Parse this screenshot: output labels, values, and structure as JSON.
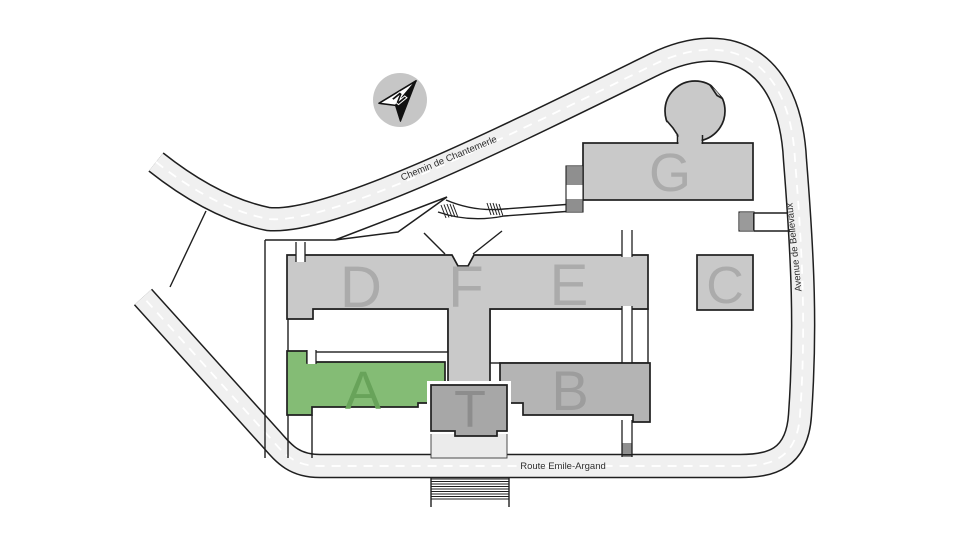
{
  "map": {
    "compass": {
      "label": "N"
    },
    "roads": {
      "chantemerle": {
        "label": "Chemin de Chantemerle"
      },
      "bellevaux": {
        "label": "Avenue de Bellevaux"
      },
      "emile_argand": {
        "label": "Route Emile-Argand"
      }
    },
    "buildings": {
      "a": {
        "label": "A",
        "fill": "#84bc75",
        "letter_color": "#68a35a",
        "highlighted": true
      },
      "b": {
        "label": "B",
        "fill": "#b4b4b4",
        "letter_color": "#9d9d9d",
        "highlighted": false
      },
      "c": {
        "label": "C",
        "fill": "#c9c9c9",
        "letter_color": "#ababab",
        "highlighted": false
      },
      "d": {
        "label": "D",
        "fill": "#c9c9c9",
        "letter_color": "#ababab",
        "highlighted": false
      },
      "e": {
        "label": "E",
        "fill": "#c9c9c9",
        "letter_color": "#ababab",
        "highlighted": false
      },
      "f": {
        "label": "F",
        "fill": "#c9c9c9",
        "letter_color": "#ababab",
        "highlighted": false
      },
      "g": {
        "label": "G",
        "fill": "#c9c9c9",
        "letter_color": "#ababab",
        "highlighted": false
      },
      "t": {
        "label": "T",
        "fill": "#a7a7a7",
        "letter_color": "#8d8d8d",
        "highlighted": false
      }
    },
    "colors": {
      "road_fill": "#f0f0f0",
      "road_outline": "#1f1f1f",
      "road_dash": "#ffffff",
      "terrain": "#ffffff",
      "plaza": "#ebebeb",
      "courtyard": "#ffffff",
      "compass_circle": "#c6c6c6",
      "highlight_green": "#84bc75"
    }
  }
}
